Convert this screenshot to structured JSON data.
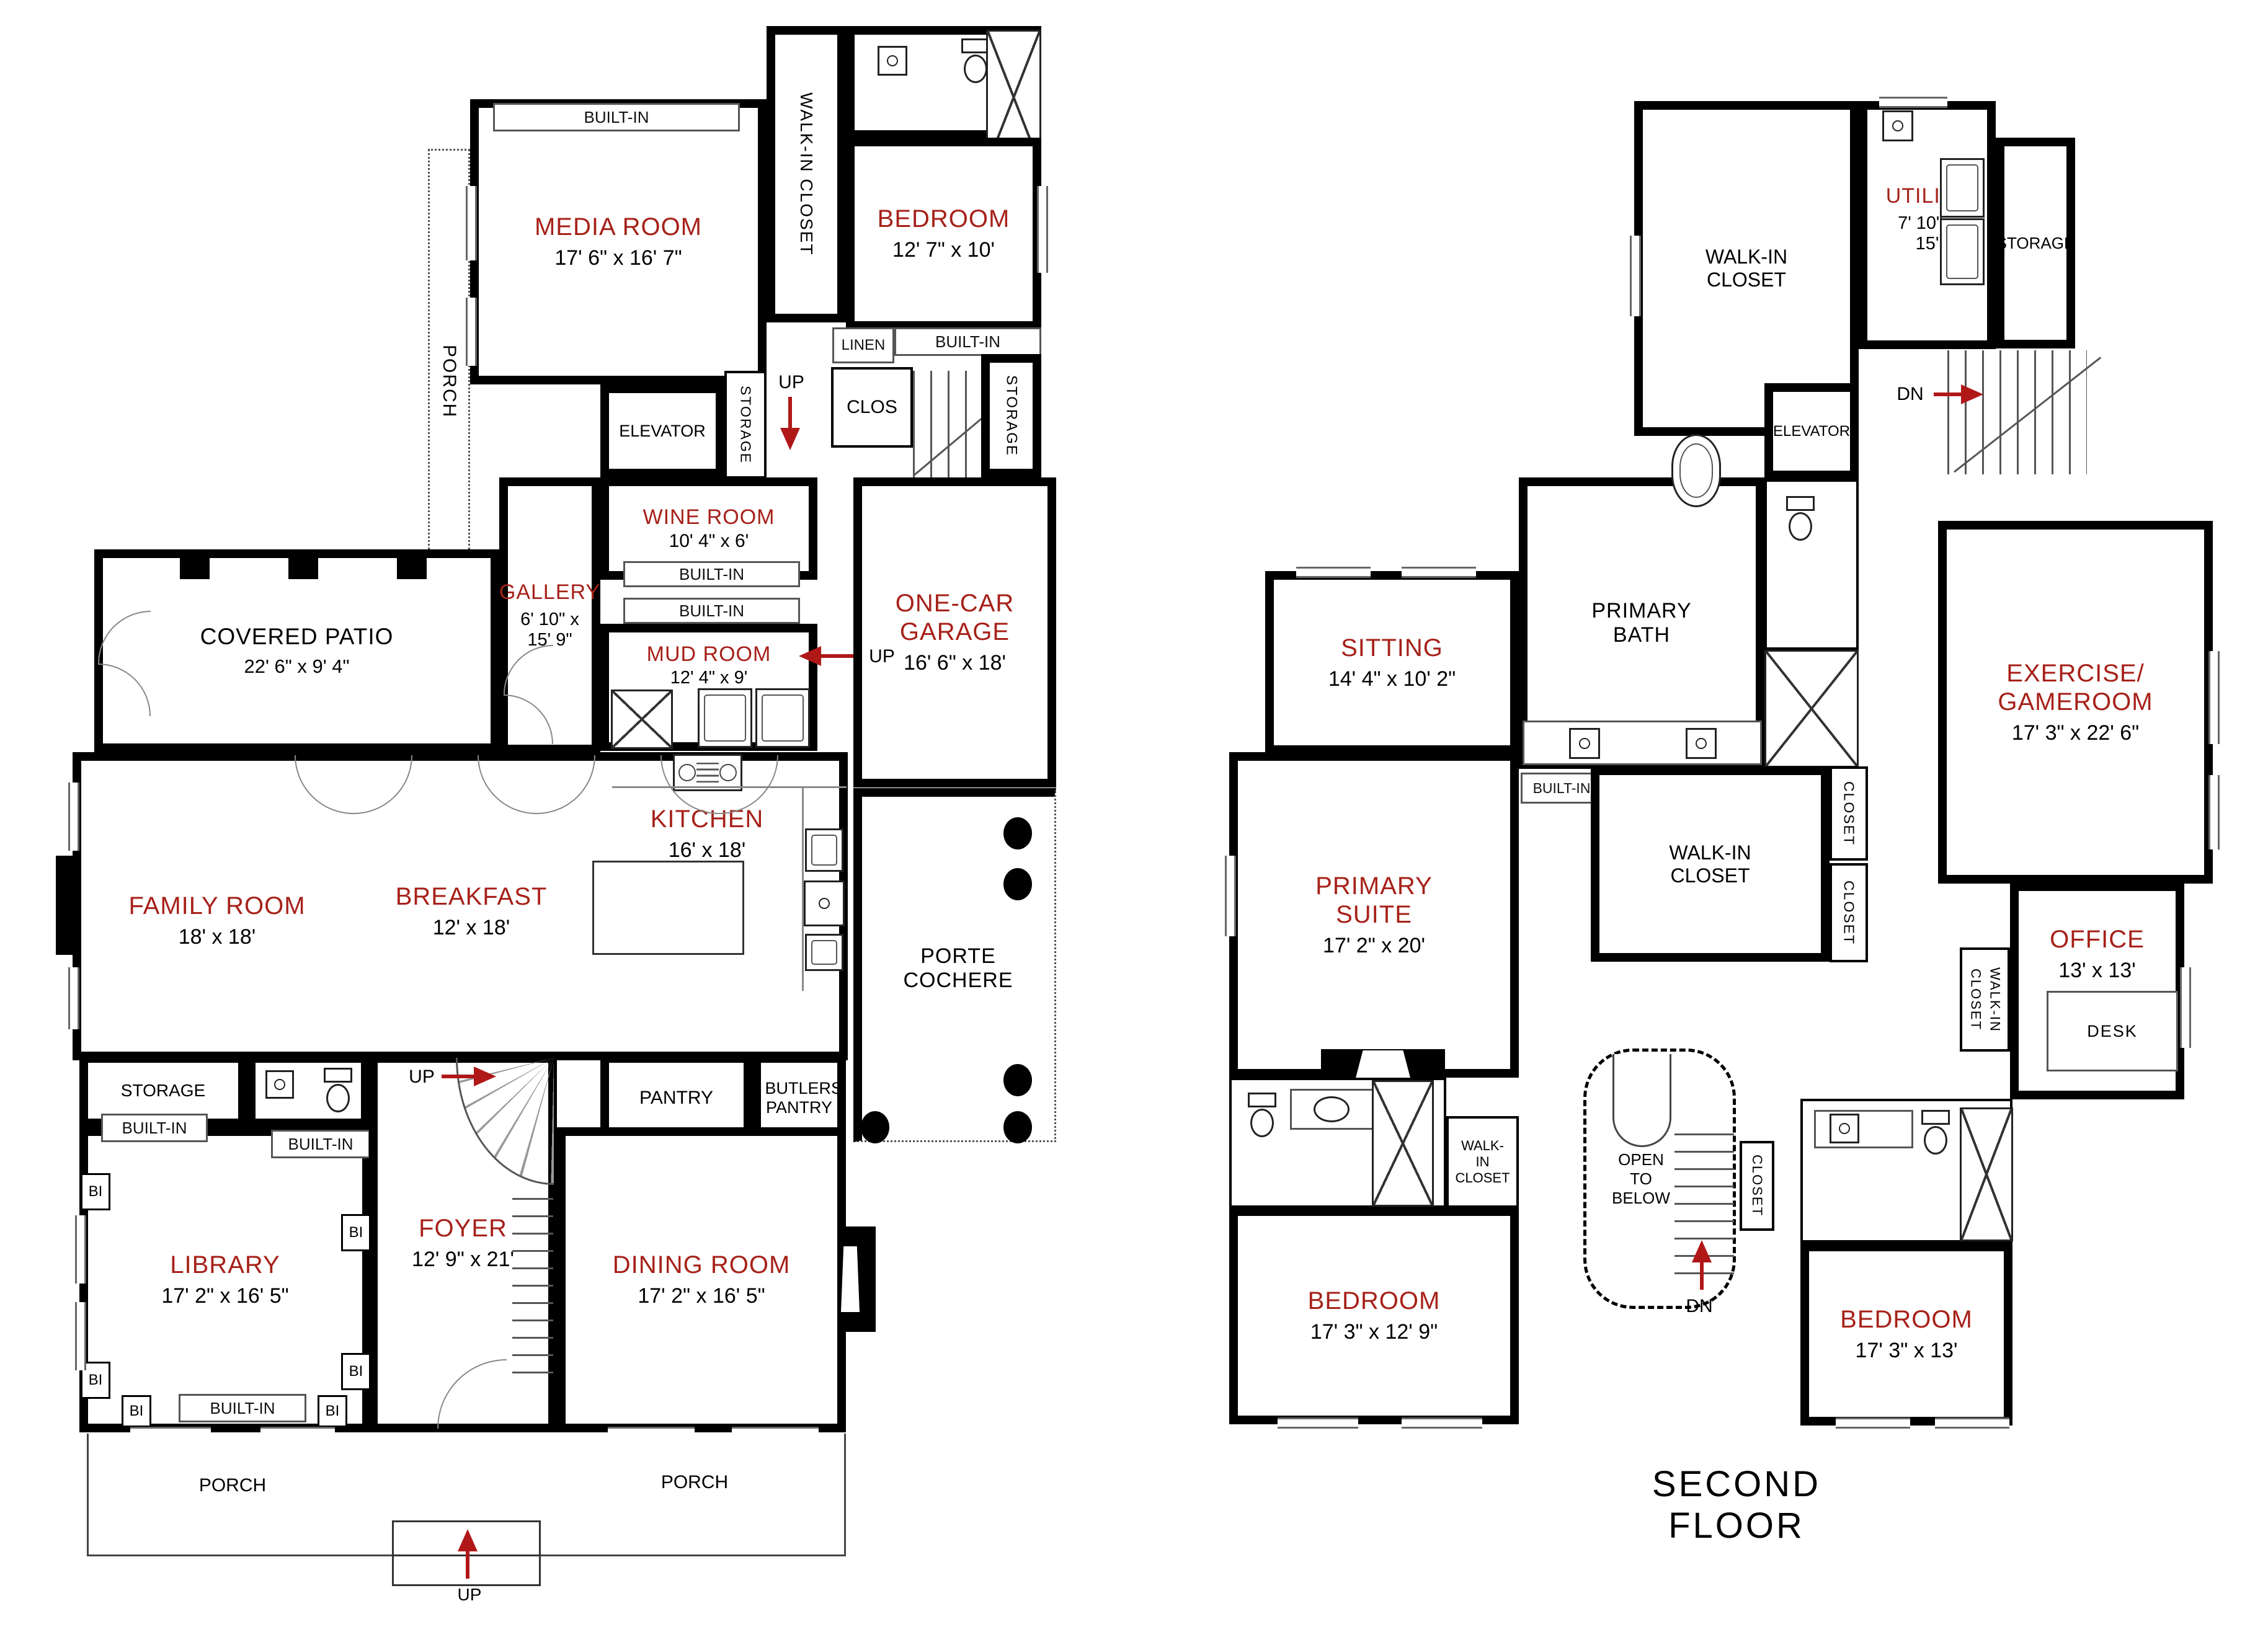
{
  "colors": {
    "accent": "#a62119",
    "wall": "#000000",
    "arrow": "#b01818"
  },
  "title": {
    "second_floor": "SECOND FLOOR"
  },
  "common": {
    "built_in": "BUILT-IN",
    "bi": "BI",
    "storage": "STORAGE",
    "up": "UP",
    "dn": "DN",
    "walk_in_closet": "WALK-IN CLOSET",
    "closet": "CLOSET",
    "clos": "CLOS",
    "linen": "LINEN",
    "elevator": "ELEVATOR",
    "porch": "PORCH",
    "pantry": "PANTRY",
    "butlers_pantry": "BUTLERS PANTRY",
    "desk": "DESK",
    "open_to_below": "OPEN TO BELOW"
  },
  "f1": {
    "media": {
      "name": "MEDIA ROOM",
      "dims": "17' 6\" x 16' 7\""
    },
    "bedroom": {
      "name": "BEDROOM",
      "dims": "12' 7\" x 10'"
    },
    "wine": {
      "name": "WINE ROOM",
      "dims": "10' 4\" x 6'"
    },
    "gallery": {
      "name": "GALLERY",
      "dims": "6' 10\" x 15' 9\""
    },
    "mud": {
      "name": "MUD ROOM",
      "dims": "12' 4\" x 9'"
    },
    "garage": {
      "name": "ONE-CAR GARAGE",
      "dims": "16' 6\" x 18'"
    },
    "patio": {
      "name": "COVERED PATIO",
      "dims": "22' 6\" x 9' 4\""
    },
    "family": {
      "name": "FAMILY ROOM",
      "dims": "18' x 18'"
    },
    "breakfast": {
      "name": "BREAKFAST",
      "dims": "12' x 18'"
    },
    "kitchen": {
      "name": "KITCHEN",
      "dims": "16' x 18'"
    },
    "porte": {
      "name": "PORTE COCHERE"
    },
    "library": {
      "name": "LIBRARY",
      "dims": "17' 2\" x 16' 5\""
    },
    "foyer": {
      "name": "FOYER",
      "dims": "12' 9\" x 21'"
    },
    "dining": {
      "name": "DINING ROOM",
      "dims": "17' 2\" x 16' 5\""
    }
  },
  "f2": {
    "utility": {
      "name": "UTILITY",
      "dims": "7' 10\" x 15'"
    },
    "sitting": {
      "name": "SITTING",
      "dims": "14' 4\" x 10' 2\""
    },
    "primary_bath": {
      "name": "PRIMARY BATH"
    },
    "suite": {
      "name": "PRIMARY SUITE",
      "dims": "17' 2\" x 20'"
    },
    "exercise": {
      "name": "EXERCISE/ GAMEROOM",
      "dims": "17' 3\" x 22' 6\""
    },
    "office": {
      "name": "OFFICE",
      "dims": "13' x 13'"
    },
    "bedroom_left": {
      "name": "BEDROOM",
      "dims": "17' 3\" x 12' 9\""
    },
    "bedroom_right": {
      "name": "BEDROOM",
      "dims": "17' 3\" x 13'"
    }
  }
}
